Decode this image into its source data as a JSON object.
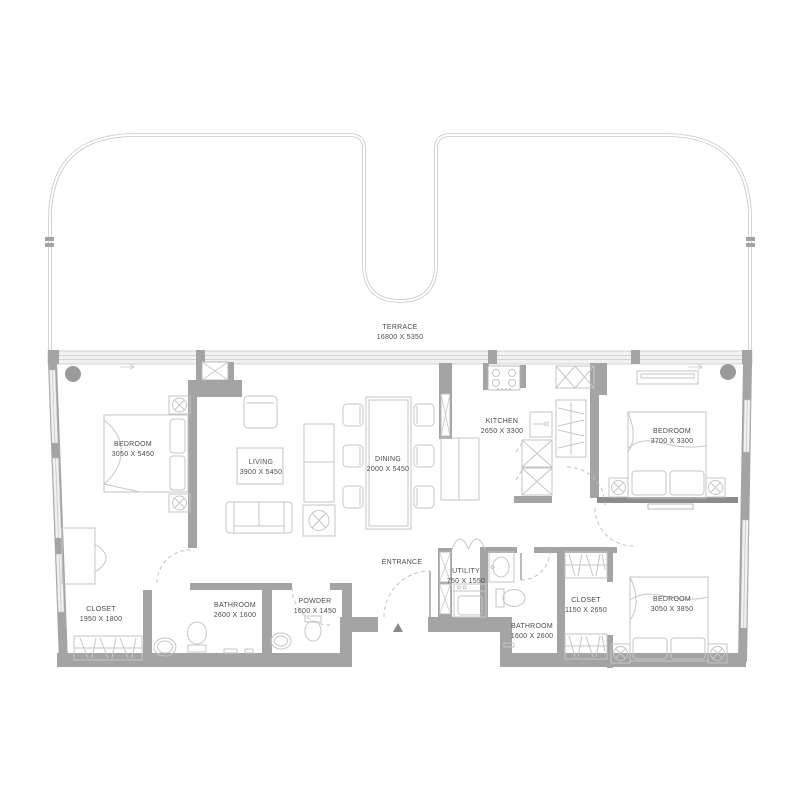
{
  "plan": {
    "title": "apartment-floor-plan",
    "labels": [
      {
        "id": "terrace",
        "name": "TERRACE",
        "dims": "16800 X 5350"
      },
      {
        "id": "bedroom-1",
        "name": "BEDROOM",
        "dims": "3050 X 5450"
      },
      {
        "id": "living",
        "name": "LIVING",
        "dims": "3900 X 5450"
      },
      {
        "id": "dining",
        "name": "DINING",
        "dims": "2000 X 5450"
      },
      {
        "id": "kitchen",
        "name": "KITCHEN",
        "dims": "2650 X 3300"
      },
      {
        "id": "bedroom-2",
        "name": "BEDROOM",
        "dims": "3700 X 3300"
      },
      {
        "id": "closet-1",
        "name": "CLOSET",
        "dims": "1950 X 1800"
      },
      {
        "id": "bathroom-1",
        "name": "BATHROOM",
        "dims": "2600 X 1600"
      },
      {
        "id": "powder",
        "name": "POWDER",
        "dims": "1600 X 1450"
      },
      {
        "id": "entrance",
        "name": "ENTRANCE",
        "dims": ""
      },
      {
        "id": "utility",
        "name": "UTILITY",
        "dims": "750 X 1550"
      },
      {
        "id": "bathroom-2",
        "name": "BATHROOM",
        "dims": "1600 X 2600"
      },
      {
        "id": "closet-2",
        "name": "CLOSET",
        "dims": "1150 X 2650"
      },
      {
        "id": "bedroom-3",
        "name": "BEDROOM",
        "dims": "3050 X 3850"
      }
    ],
    "markers": {
      "entrance_marker": "triangle-up"
    },
    "colors": {
      "wall": "#a4a4a4",
      "wall_dark": "#8c8c8c",
      "furniture_line": "#c6c6c6",
      "terrace_outline": "#c9c9c9",
      "label_text": "#4c4c4c",
      "background": "#ffffff"
    }
  }
}
